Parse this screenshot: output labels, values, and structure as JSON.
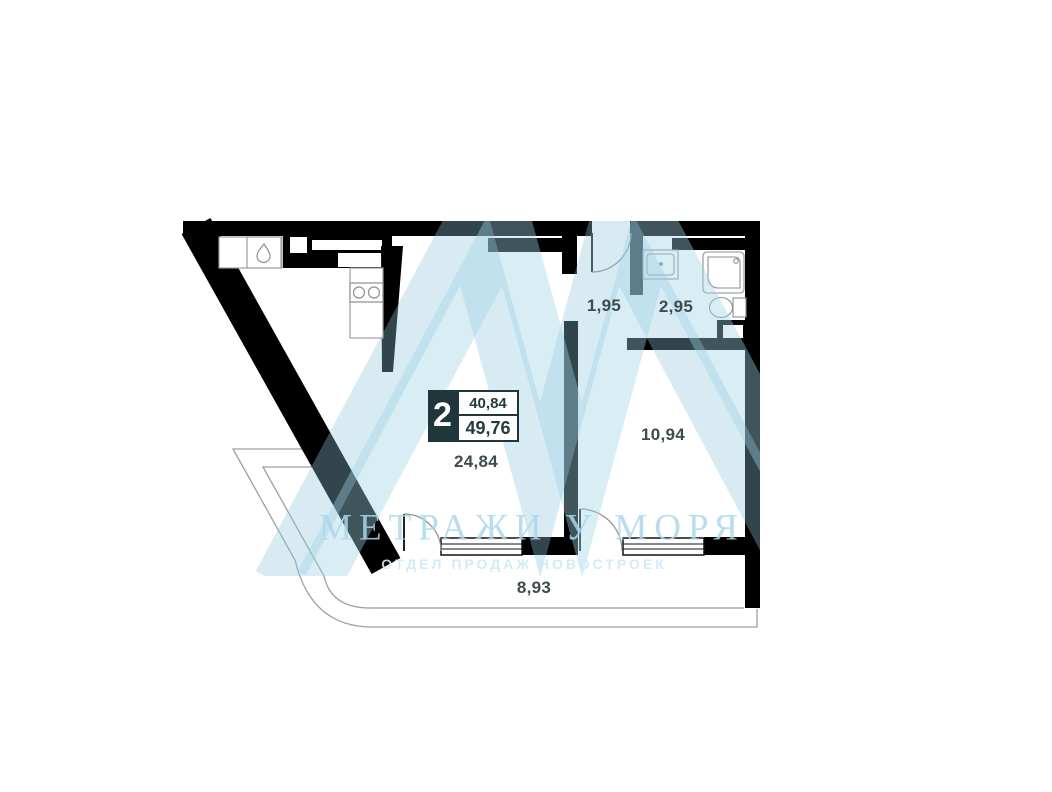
{
  "watermark": {
    "title": "МЕТРАЖИ У МОРЯ",
    "subtitle": "ОТДЕЛ ПРОДАЖ НОВОСТРОЕК"
  },
  "badge": {
    "rooms_count": "2",
    "upper_area": "40,84",
    "lower_area": "49,76"
  },
  "rooms": {
    "living": {
      "area": "24,84"
    },
    "bedroom": {
      "area": "10,94"
    },
    "hallway": {
      "area": "1,95"
    },
    "bathroom": {
      "area": "2,95"
    },
    "terrace": {
      "area": "8,93"
    }
  },
  "colors": {
    "wall": "#000000",
    "label": "#3e4b4f",
    "badge_bg": "#20363b",
    "watermark_stripe": "#8fc6de",
    "watermark_text": "#aad7eb"
  }
}
